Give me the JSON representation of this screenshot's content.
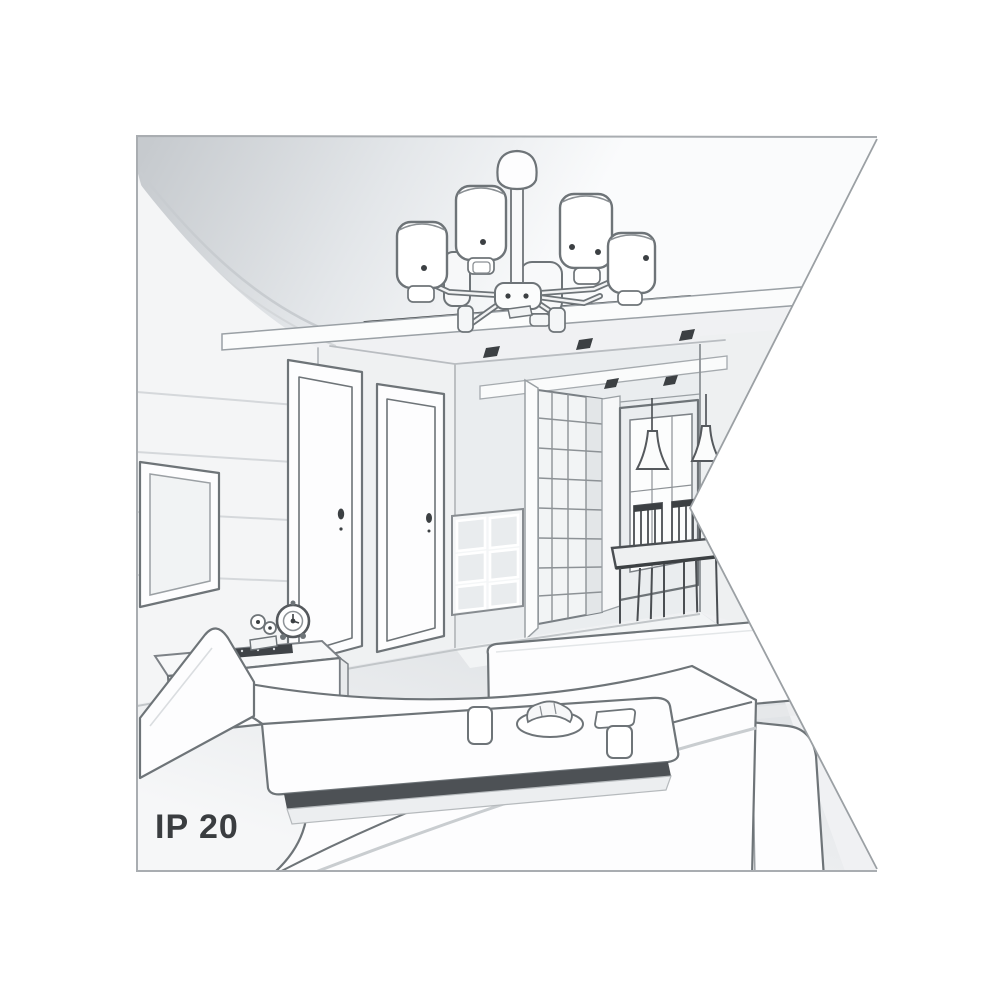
{
  "illustration": {
    "kind": "interior-room-perspective-line-drawing",
    "label": "IP 20",
    "scene_objects": [
      "ceiling-chandelier-6-shades",
      "recessed-ceiling-spotlights",
      "left-door",
      "right-door",
      "wall-mounted-tv",
      "sideboard-with-clock-and-soundbar",
      "drawer-cabinet",
      "grid-wardrobe",
      "hallway-window",
      "pendant-cone-lights",
      "dining-table-with-chairs",
      "left-sofa",
      "right-sofa",
      "ottoman",
      "coffee-table-with-cups-plate-and-tray"
    ]
  },
  "colors": {
    "background": "#ffffff",
    "frame_border": "#a9adb1",
    "line": "#6e7478",
    "line_dark": "#3c4043",
    "line_soft": "#b9bdc1",
    "ceiling_dark": "#c6cace",
    "ceiling_light": "#fafbfc",
    "wall": "#f0f1f3",
    "wall_left": "#f4f5f6",
    "hall_wall": "#eaedef",
    "floor": "#e6e8ea",
    "furniture_fill": "#fdfdfe",
    "accent_dark": "#4d5155",
    "label_text": "#3a3d40"
  }
}
